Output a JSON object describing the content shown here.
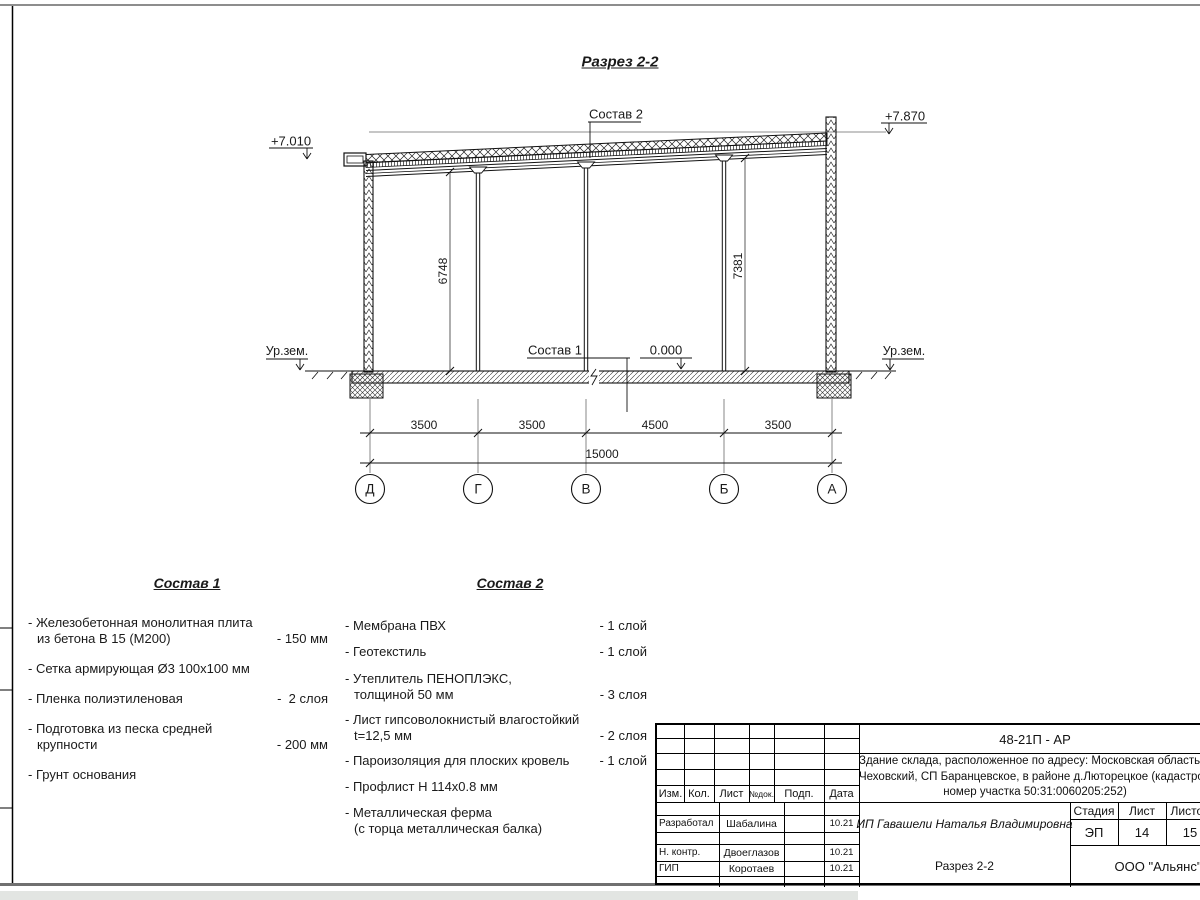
{
  "sheet": {
    "title": "Разрез 2-2"
  },
  "section": {
    "elev_left": "+7.010",
    "elev_right": "+7.870",
    "layer2_label": "Состав 2",
    "layer1_label": "Состав 1",
    "zero_level": "0.000",
    "ground_left": "Ур.зем.",
    "ground_right": "Ур.зем.",
    "height_dims": [
      "6748",
      "7381"
    ],
    "span_dims": [
      "3500",
      "3500",
      "4500",
      "3500"
    ],
    "total_dim": "15000",
    "axes": [
      "Д",
      "Г",
      "В",
      "Б",
      "А"
    ]
  },
  "sostav1": {
    "title": "Состав 1",
    "items": [
      {
        "text": "- Железобетонная  монолитная плита\nиз бетона В 15 (М200)",
        "qty": "- 150 мм"
      },
      {
        "text": "- Сетка армирующая Ø3 100х100 мм",
        "qty": ""
      },
      {
        "text": "- Пленка полиэтиленовая",
        "qty": "-  2 слоя"
      },
      {
        "text": "- Подготовка из песка средней\nкрупности",
        "qty": "- 200 мм"
      },
      {
        "text": "- Грунт основания",
        "qty": ""
      }
    ]
  },
  "sostav2": {
    "title": "Состав 2",
    "items": [
      {
        "text": "- Мембрана ПВХ",
        "qty": "- 1 слой"
      },
      {
        "text": "- Геотекстиль",
        "qty": "- 1 слой"
      },
      {
        "text": "- Утеплитель ПЕНОПЛЭКС,\nтолщиной 50 мм",
        "qty": "- 3 слоя"
      },
      {
        "text": "- Лист гипсоволокнистый влагостойкий\nt=12,5 мм",
        "qty": "- 2 слоя"
      },
      {
        "text": "- Пароизоляция для плоских кровель",
        "qty": "- 1 слой"
      },
      {
        "text": "- Профлист Н 114х0.8 мм",
        "qty": ""
      },
      {
        "text": "- Металлическая ферма\n(с торца металлическая балка)",
        "qty": ""
      }
    ]
  },
  "titleblock": {
    "doc_code": "48-21П - АР",
    "address_lines": [
      "Здание склада, расположенное по адресу: Московская область, р",
      "Чеховский, СП Баранцевское, в районе д.Люторецкое  (кадастровы",
      "номер участка 50:31:0060205:252)"
    ],
    "columns": [
      "Изм.",
      "Кол.",
      "Лист",
      "№док.",
      "Подп.",
      "Дата"
    ],
    "rows": [
      {
        "role": "Разработал",
        "name": "Шабалина",
        "date": "10.21"
      },
      {
        "role": "Н. контр.",
        "name": "Двоеглазов",
        "date": "10.21"
      },
      {
        "role": "ГИП",
        "name": "Коротаев",
        "date": "10.21"
      }
    ],
    "client": "ИП Гавашели Наталья Владимировна",
    "stage_label": "Стадия",
    "sheet_label": "Лист",
    "sheets_label": "Листов",
    "stage": "ЭП",
    "sheet_num": "14",
    "sheets_total": "15",
    "drawing_name": "Разрез 2-2",
    "company": "ООО \"Альянс\""
  }
}
